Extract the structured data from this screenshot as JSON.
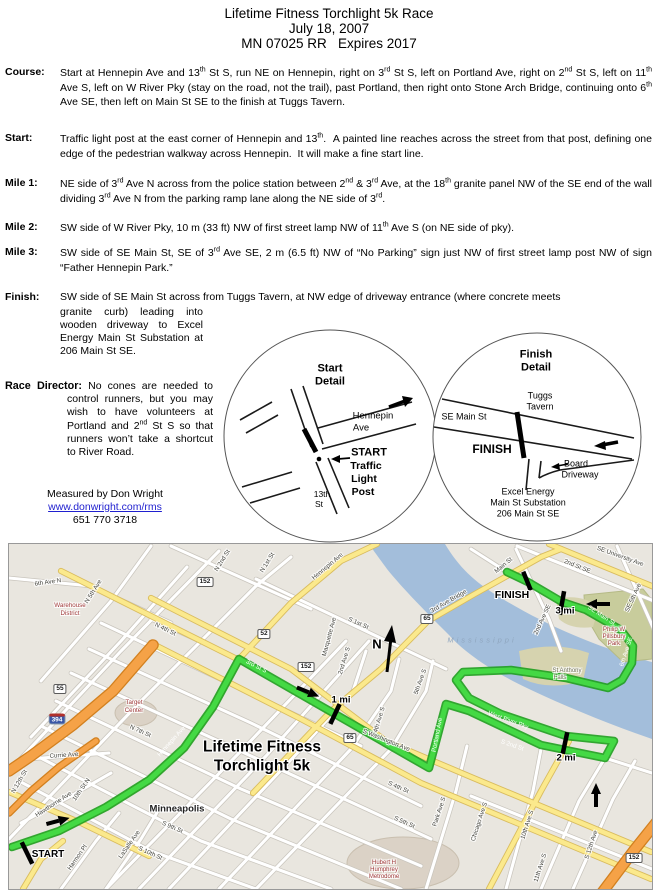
{
  "header": {
    "lines": [
      "Lifetime Fitness Torchlight 5k Race",
      "July 18, 2007",
      "MN 07025 RR   Expires 2017"
    ]
  },
  "sections": [
    {
      "id": "course",
      "label": "Course:",
      "html": "Start at Hennepin Ave and 13<sup>th</sup> St S, run NE on Hennepin, right on 3<sup>rd</sup> St S, left on Portland Ave, right on 2<sup>nd</sup> St S, left on 11<sup>th</sup> Ave S, left on W River Pky (stay on the road, not the trail), past Portland, then right onto Stone Arch Bridge, continuing onto 6<sup>th</sup> Ave SE, then left on Main St SE to the finish at Tuggs Tavern."
    },
    {
      "id": "start",
      "label": "Start:",
      "html": "Traffic light post at the east corner of Hennepin and 13<sup>th</sup>.  A painted line reaches across the street from that post, defining one edge of the pedestrian walkway across Hennepin.  It will make a fine start line."
    },
    {
      "id": "mile1",
      "label": "Mile 1:",
      "html": "NE side of 3<sup>rd</sup> Ave N across from the police station between 2<sup>nd</sup> &amp; 3<sup>rd</sup> Ave, at the 18<sup>th</sup> granite panel NW of the SE end of the wall dividing 3<sup>rd</sup> Ave N from the parking ramp lane along the NE side of 3<sup>rd</sup>."
    },
    {
      "id": "mile2",
      "label": "Mile 2:",
      "html": "SW side of W River Pky, 10 m (33 ft) NW of first street lamp NW of 11<sup>th</sup> Ave S (on NE side of pky)."
    },
    {
      "id": "mile3",
      "label": "Mile 3:",
      "html": "SW side of SE Main St, SE of 3<sup>rd</sup> Ave SE, 2 m (6.5 ft) NW of “No Parking” sign just NW of first street lamp post NW of sign “Father Hennepin Park.”"
    }
  ],
  "finish_section": {
    "label": "Finish:",
    "wide_html": "SW side of SE Main St across from Tuggs Tavern, at NW edge of driveway entrance (where concrete meets",
    "narrow_html": "granite curb) leading into wooden driveway to Excel Energy Main St Substation at 206 Main St SE."
  },
  "race_director": {
    "label": "Race Director:",
    "html": "No cones are needed to control runners, but you may wish to have volunteers at Portland and 2<sup>nd</sup> St S so that runners won’t take a shortcut to River Road."
  },
  "credit": {
    "measured_by": "Measured by Don Wright",
    "link": "www.donwright.com/rms",
    "phone": "651 770 3718"
  },
  "details": {
    "labels": [
      {
        "t": "Start",
        "x": 330,
        "y": 369,
        "b": 1,
        "s": 11,
        "c": "#000",
        "n": "start-detail-title"
      },
      {
        "t": "Detail",
        "x": 330,
        "y": 382,
        "b": 1,
        "s": 11,
        "c": "#000",
        "n": "start-detail-title"
      },
      {
        "t": "Hennepin",
        "x": 373,
        "y": 416,
        "s": 9.5,
        "c": "#000",
        "n": "hennepin-ave-label"
      },
      {
        "t": "Ave",
        "x": 361,
        "y": 428,
        "s": 9.5,
        "c": "#000",
        "n": "hennepin-ave-label"
      },
      {
        "t": "START",
        "x": 369,
        "y": 453,
        "b": 1,
        "s": 11,
        "c": "#000",
        "n": "start-callout"
      },
      {
        "t": "Traffic",
        "x": 366,
        "y": 466,
        "b": 1,
        "s": 10.5,
        "c": "#000",
        "n": "start-callout"
      },
      {
        "t": "Light",
        "x": 364,
        "y": 479,
        "b": 1,
        "s": 10.5,
        "c": "#000",
        "n": "start-callout"
      },
      {
        "t": "Post",
        "x": 363,
        "y": 492,
        "b": 1,
        "s": 10.5,
        "c": "#000",
        "n": "start-callout"
      },
      {
        "t": "13th",
        "x": 322,
        "y": 494,
        "s": 8.5,
        "c": "#000",
        "n": "street-13th-label"
      },
      {
        "t": "St",
        "x": 319,
        "y": 504,
        "s": 8.5,
        "c": "#000",
        "n": "street-13th-label"
      },
      {
        "t": "Finish",
        "x": 536,
        "y": 355,
        "b": 1,
        "s": 11,
        "c": "#000",
        "n": "finish-detail-title"
      },
      {
        "t": "Detail",
        "x": 536,
        "y": 368,
        "b": 1,
        "s": 11,
        "c": "#000",
        "n": "finish-detail-title"
      },
      {
        "t": "Tuggs",
        "x": 540,
        "y": 396,
        "s": 9,
        "c": "#000",
        "n": "tuggs-tavern-label"
      },
      {
        "t": "Tavern",
        "x": 540,
        "y": 407,
        "s": 9,
        "c": "#000",
        "n": "tuggs-tavern-label"
      },
      {
        "t": "SE Main St",
        "x": 464,
        "y": 417,
        "s": 9,
        "c": "#000",
        "n": "se-main-st-label"
      },
      {
        "t": "FINISH",
        "x": 492,
        "y": 449,
        "b": 1,
        "s": 12,
        "c": "#000",
        "n": "finish-callout"
      },
      {
        "t": "Board",
        "x": 576,
        "y": 464,
        "s": 9,
        "c": "#000",
        "n": "board-driveway-label"
      },
      {
        "t": "Driveway",
        "x": 580,
        "y": 475,
        "s": 9,
        "c": "#000",
        "n": "board-driveway-label"
      },
      {
        "t": "Excel Energy",
        "x": 528,
        "y": 492,
        "s": 9,
        "c": "#000",
        "n": "excel-energy-label"
      },
      {
        "t": "Main St Substation",
        "x": 528,
        "y": 503,
        "s": 9,
        "c": "#000",
        "n": "excel-energy-label"
      },
      {
        "t": "206 Main St SE",
        "x": 528,
        "y": 514,
        "s": 9,
        "c": "#000",
        "n": "excel-energy-label"
      }
    ]
  },
  "map": {
    "labels": [
      {
        "t": "Lifetime Fitness",
        "x": 262,
        "y": 747,
        "b": 1,
        "s": 15.5,
        "c": "#000",
        "h": 1,
        "n": "map-title"
      },
      {
        "t": "Torchlight 5k",
        "x": 262,
        "y": 766,
        "b": 1,
        "s": 15.5,
        "c": "#000",
        "h": 1,
        "n": "map-title"
      },
      {
        "t": "START",
        "x": 48,
        "y": 855,
        "b": 1,
        "s": 10,
        "c": "#000",
        "h": 1,
        "n": "start-marker-label"
      },
      {
        "t": "FINISH",
        "x": 512,
        "y": 595,
        "b": 1,
        "s": 10.5,
        "c": "#000",
        "h": 1,
        "n": "finish-marker-label"
      },
      {
        "t": "1 mi",
        "x": 341,
        "y": 700,
        "b": 1,
        "s": 9.5,
        "c": "#000",
        "h": 1,
        "n": "mile1-marker-label"
      },
      {
        "t": "2 mi",
        "x": 566,
        "y": 758,
        "b": 1,
        "s": 9.5,
        "c": "#000",
        "h": 1,
        "n": "mile2-marker-label"
      },
      {
        "t": "3 mi",
        "x": 565,
        "y": 611,
        "b": 1,
        "s": 9.5,
        "c": "#000",
        "h": 1,
        "n": "mile3-marker-label"
      },
      {
        "t": "N",
        "x": 377,
        "y": 644,
        "b": 1,
        "s": 13,
        "c": "#000",
        "h": 1,
        "n": "north-label"
      },
      {
        "t": "Minneapolis",
        "x": 177,
        "y": 809,
        "b": 1,
        "s": 9.5,
        "c": "#222",
        "h": 1,
        "n": "city-label"
      },
      {
        "t": "Warehouse",
        "x": 70,
        "y": 606,
        "s": 6.2,
        "c": "#A03A3A",
        "h": 1
      },
      {
        "t": "District",
        "x": 70,
        "y": 614,
        "s": 6.2,
        "c": "#A03A3A",
        "h": 1
      },
      {
        "t": "Target",
        "x": 134,
        "y": 703,
        "s": 6.2,
        "c": "#A03A3A",
        "h": 1
      },
      {
        "t": "Center",
        "x": 134,
        "y": 711,
        "s": 6.2,
        "c": "#A03A3A",
        "h": 1
      },
      {
        "t": "Hubert H",
        "x": 384,
        "y": 863,
        "s": 6,
        "c": "#A03A3A",
        "h": 1
      },
      {
        "t": "Humphrey",
        "x": 384,
        "y": 870,
        "s": 6,
        "c": "#A03A3A",
        "h": 1
      },
      {
        "t": "Metrodome",
        "x": 384,
        "y": 877,
        "s": 6,
        "c": "#A03A3A",
        "h": 1
      },
      {
        "t": "Philip W",
        "x": 614,
        "y": 630,
        "s": 6,
        "c": "#A03A3A",
        "h": 1
      },
      {
        "t": "Pillsbury",
        "x": 614,
        "y": 637,
        "s": 6,
        "c": "#A03A3A",
        "h": 1
      },
      {
        "t": "Park",
        "x": 614,
        "y": 644,
        "s": 6,
        "c": "#A03A3A",
        "h": 1
      },
      {
        "t": "St Anthony",
        "x": 567,
        "y": 671,
        "s": 6,
        "c": "#6F6F55",
        "h": 1
      },
      {
        "t": "Falls",
        "x": 560,
        "y": 678,
        "s": 6,
        "c": "#6F6F55",
        "h": 1
      },
      {
        "t": "Mississippi",
        "x": 482,
        "y": 640,
        "s": 7.5,
        "i": 1,
        "c": "#8FA6BF",
        "sp": 3
      },
      {
        "t": "6th Ave N",
        "x": 48,
        "y": 583,
        "r": -8,
        "s": 6.2,
        "h": 1
      },
      {
        "t": "N 5th Ave",
        "x": 94,
        "y": 592,
        "r": -58,
        "s": 6.2,
        "h": 1
      },
      {
        "t": "N 4th St",
        "x": 165,
        "y": 630,
        "r": 26,
        "s": 6.2,
        "h": 1
      },
      {
        "t": "N 2nd St",
        "x": 223,
        "y": 561,
        "r": -58,
        "s": 6.2,
        "h": 1
      },
      {
        "t": "N 1st St",
        "x": 268,
        "y": 563,
        "r": -58,
        "s": 6.2,
        "h": 1
      },
      {
        "t": "Hennepin Ave",
        "x": 328,
        "y": 567,
        "r": -40,
        "s": 6.2,
        "h": 1
      },
      {
        "t": "Marquette Ave",
        "x": 330,
        "y": 637,
        "r": -75,
        "s": 6.2,
        "h": 1
      },
      {
        "t": "2nd Ave S",
        "x": 345,
        "y": 661,
        "r": -73,
        "s": 6.2,
        "h": 1
      },
      {
        "t": "S 1st St",
        "x": 358,
        "y": 624,
        "r": 24,
        "s": 6.2,
        "h": 1
      },
      {
        "t": "4th Ave S",
        "x": 380,
        "y": 720,
        "r": -73,
        "s": 6.2,
        "h": 1
      },
      {
        "t": "5th Ave S",
        "x": 421,
        "y": 682,
        "r": -70,
        "s": 6.2,
        "h": 1
      },
      {
        "t": "S Washington Ave",
        "x": 386,
        "y": 741,
        "r": 22,
        "s": 6.2,
        "h": 1
      },
      {
        "t": "S 4th St",
        "x": 398,
        "y": 788,
        "r": 24,
        "s": 6.2,
        "h": 1
      },
      {
        "t": "S 5th St",
        "x": 404,
        "y": 823,
        "r": 24,
        "s": 6.2,
        "h": 1
      },
      {
        "t": "Park Ave S",
        "x": 440,
        "y": 812,
        "r": -72,
        "s": 6.2,
        "h": 1
      },
      {
        "t": "Chicago Ave S",
        "x": 480,
        "y": 822,
        "r": -72,
        "s": 6.2,
        "h": 1
      },
      {
        "t": "10th Ave S",
        "x": 528,
        "y": 825,
        "r": -72,
        "s": 6.2,
        "h": 1
      },
      {
        "t": "11th Ave S",
        "x": 541,
        "y": 868,
        "r": -72,
        "s": 6.2,
        "h": 1
      },
      {
        "t": "S 12th Ave",
        "x": 592,
        "y": 845,
        "r": -72,
        "s": 6.2,
        "h": 1
      },
      {
        "t": "Hawthorne Ave",
        "x": 54,
        "y": 805,
        "r": -33,
        "s": 6.2,
        "h": 1
      },
      {
        "t": "Currie Ave",
        "x": 64,
        "y": 756,
        "r": -4,
        "s": 6.2,
        "h": 1
      },
      {
        "t": "N 7th St",
        "x": 140,
        "y": 732,
        "r": 24,
        "s": 6.2,
        "h": 1
      },
      {
        "t": "N 12th St",
        "x": 20,
        "y": 782,
        "r": -60,
        "s": 6.2,
        "h": 1
      },
      {
        "t": "10th St N",
        "x": 82,
        "y": 790,
        "r": -55,
        "s": 6.2,
        "h": 1
      },
      {
        "t": "Harmon Pl",
        "x": 78,
        "y": 858,
        "r": -55,
        "s": 6.2,
        "h": 1
      },
      {
        "t": "LaSalle Ave",
        "x": 130,
        "y": 845,
        "r": -55,
        "s": 6.2,
        "h": 1
      },
      {
        "t": "S 9th St",
        "x": 172,
        "y": 828,
        "r": 24,
        "s": 6.2,
        "h": 1
      },
      {
        "t": "S 10th St",
        "x": 150,
        "y": 854,
        "r": 24,
        "s": 6.2,
        "h": 1
      },
      {
        "t": "SE University Ave",
        "x": 620,
        "y": 557,
        "r": 20,
        "s": 6.2,
        "h": 1
      },
      {
        "t": "2nd St SE",
        "x": 577,
        "y": 567,
        "r": 22,
        "s": 6.2,
        "h": 1
      },
      {
        "t": "SE 5th Ave",
        "x": 634,
        "y": 598,
        "r": -65,
        "s": 6.2,
        "h": 1
      },
      {
        "t": "2nd Ave SE",
        "x": 543,
        "y": 620,
        "r": -65,
        "s": 6.2,
        "h": 1
      },
      {
        "t": "Main St",
        "x": 504,
        "y": 566,
        "r": -40,
        "s": 6.2,
        "h": 1
      },
      {
        "t": "3rd Ave Bridge",
        "x": 449,
        "y": 602,
        "r": -30,
        "s": 6.2,
        "h": 1
      },
      {
        "t": "Hennepin Ave",
        "x": 172,
        "y": 742,
        "r": -48,
        "s": 6.2,
        "c": "#fff"
      },
      {
        "t": "3rd St S",
        "x": 256,
        "y": 667,
        "r": 27,
        "s": 6.2,
        "c": "#fff"
      },
      {
        "t": "S 2nd St",
        "x": 512,
        "y": 746,
        "r": 19,
        "s": 6.2,
        "c": "#fff"
      },
      {
        "t": "West River Pky",
        "x": 508,
        "y": 721,
        "r": 20,
        "s": 6.2,
        "c": "#fff"
      },
      {
        "t": "Portland Ave",
        "x": 438,
        "y": 735,
        "r": -79,
        "s": 6.2,
        "c": "#fff"
      },
      {
        "t": "6th Ave SE",
        "x": 627,
        "y": 652,
        "r": -72,
        "s": 6.2,
        "c": "#fff"
      },
      {
        "t": "SE Main St",
        "x": 601,
        "y": 616,
        "r": 33,
        "s": 6.2,
        "c": "#fff"
      }
    ],
    "shields": [
      {
        "n": "152",
        "x": 205,
        "y": 582
      },
      {
        "n": "152",
        "x": 306,
        "y": 667
      },
      {
        "n": "52",
        "x": 264,
        "y": 634
      },
      {
        "n": "55",
        "x": 60,
        "y": 689
      },
      {
        "n": "65",
        "x": 427,
        "y": 619
      },
      {
        "n": "65",
        "x": 350,
        "y": 738
      },
      {
        "n": "152",
        "x": 634,
        "y": 858
      },
      {
        "n": "394",
        "x": 57,
        "y": 719,
        "i": 1
      }
    ],
    "route": [
      [
        11,
        846
      ],
      [
        58,
        830
      ],
      [
        105,
        806
      ],
      [
        148,
        779
      ],
      [
        183,
        747
      ],
      [
        212,
        706
      ],
      [
        238,
        658
      ],
      [
        428,
        767
      ],
      [
        445,
        703
      ],
      [
        468,
        710
      ],
      [
        540,
        744
      ],
      [
        604,
        757
      ],
      [
        613,
        740
      ],
      [
        565,
        735
      ],
      [
        500,
        713
      ],
      [
        468,
        697
      ],
      [
        455,
        679
      ],
      [
        462,
        671
      ],
      [
        510,
        669
      ],
      [
        565,
        677
      ],
      [
        607,
        687
      ],
      [
        621,
        679
      ],
      [
        631,
        662
      ],
      [
        632,
        645
      ],
      [
        620,
        629
      ],
      [
        585,
        609
      ],
      [
        561,
        601
      ],
      [
        527,
        581
      ],
      [
        506,
        571
      ]
    ],
    "ticks": [
      {
        "x": 26,
        "y": 852,
        "r": 64,
        "l": 24
      },
      {
        "x": 334,
        "y": 713,
        "r": 115,
        "l": 22
      },
      {
        "x": 564,
        "y": 742,
        "r": 102,
        "l": 22
      },
      {
        "x": 561,
        "y": 602,
        "r": 100,
        "l": 24
      },
      {
        "x": 526,
        "y": 580,
        "r": 68,
        "l": 20
      }
    ],
    "arrows": [
      {
        "x": 57,
        "y": 820,
        "r": -15
      },
      {
        "x": 307,
        "y": 691,
        "r": 22
      },
      {
        "x": 595,
        "y": 794,
        "r": -90
      },
      {
        "x": 597,
        "y": 603,
        "r": 180
      }
    ]
  }
}
